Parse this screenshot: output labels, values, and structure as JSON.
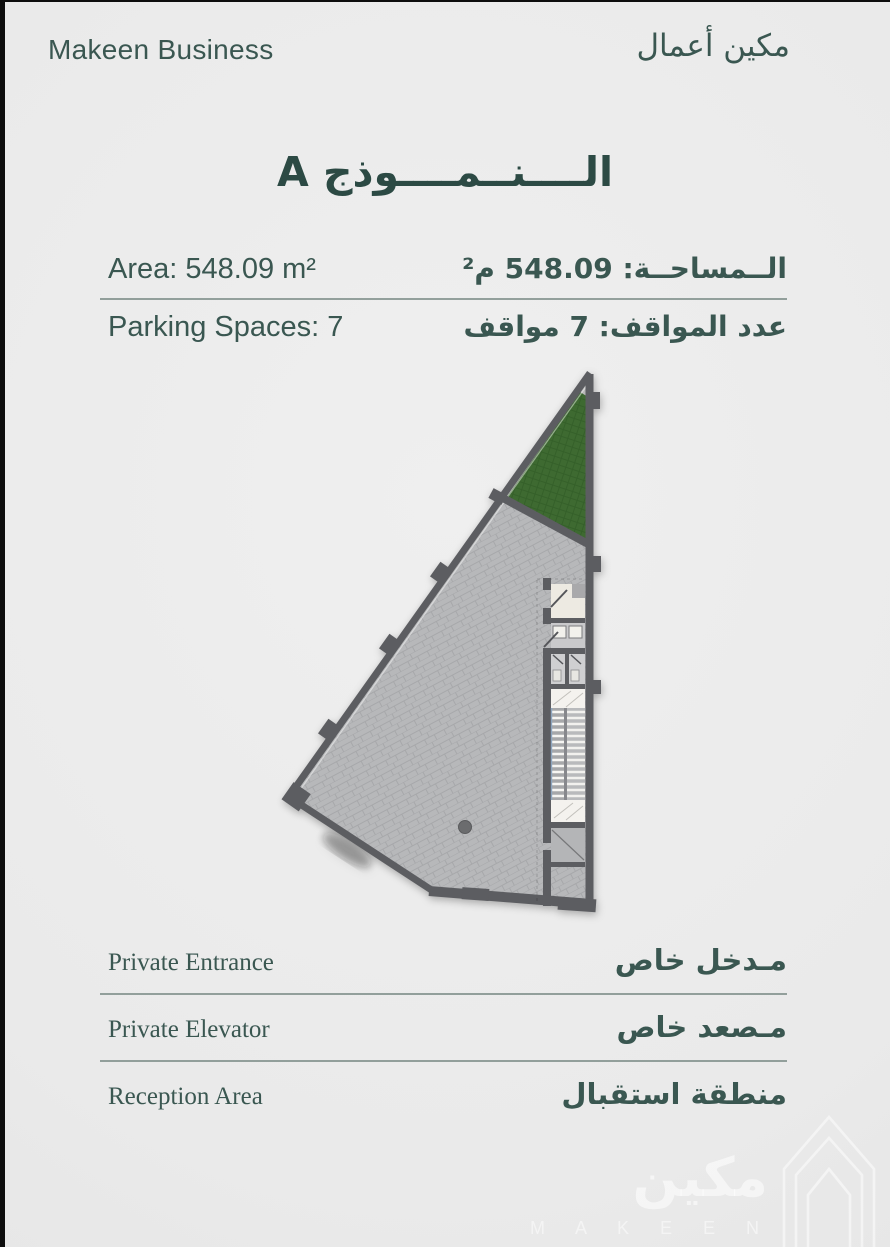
{
  "colors": {
    "bg": "#eaeaea",
    "edge": "#0d0d0d",
    "accent": "#3a5751",
    "title": "#2c4a44",
    "wall": "#5c5d61",
    "floor": "#b7b8ba",
    "green": "#3e6a31",
    "watermark": "rgba(255,255,255,.55)"
  },
  "header": {
    "business_en": "Makeen Business",
    "business_ar": "مكين أعمال"
  },
  "model": {
    "title": "الــــنــمــــوذج A"
  },
  "specs": {
    "area": {
      "en": "Area: 548.09 m²",
      "ar": "الــمساحــة: 548.09 م²"
    },
    "parking": {
      "en": "Parking Spaces: 7",
      "ar": "عدد المواقف: 7 مواقف"
    }
  },
  "features": [
    {
      "en": "Private Entrance",
      "ar": "مـدخل خاص"
    },
    {
      "en": "Private Elevator",
      "ar": "مـصعد خاص"
    },
    {
      "en": "Reception Area",
      "ar": "منطقة استقبال"
    }
  ],
  "watermark": {
    "ar": "مكين",
    "en": "M A K E E N"
  }
}
